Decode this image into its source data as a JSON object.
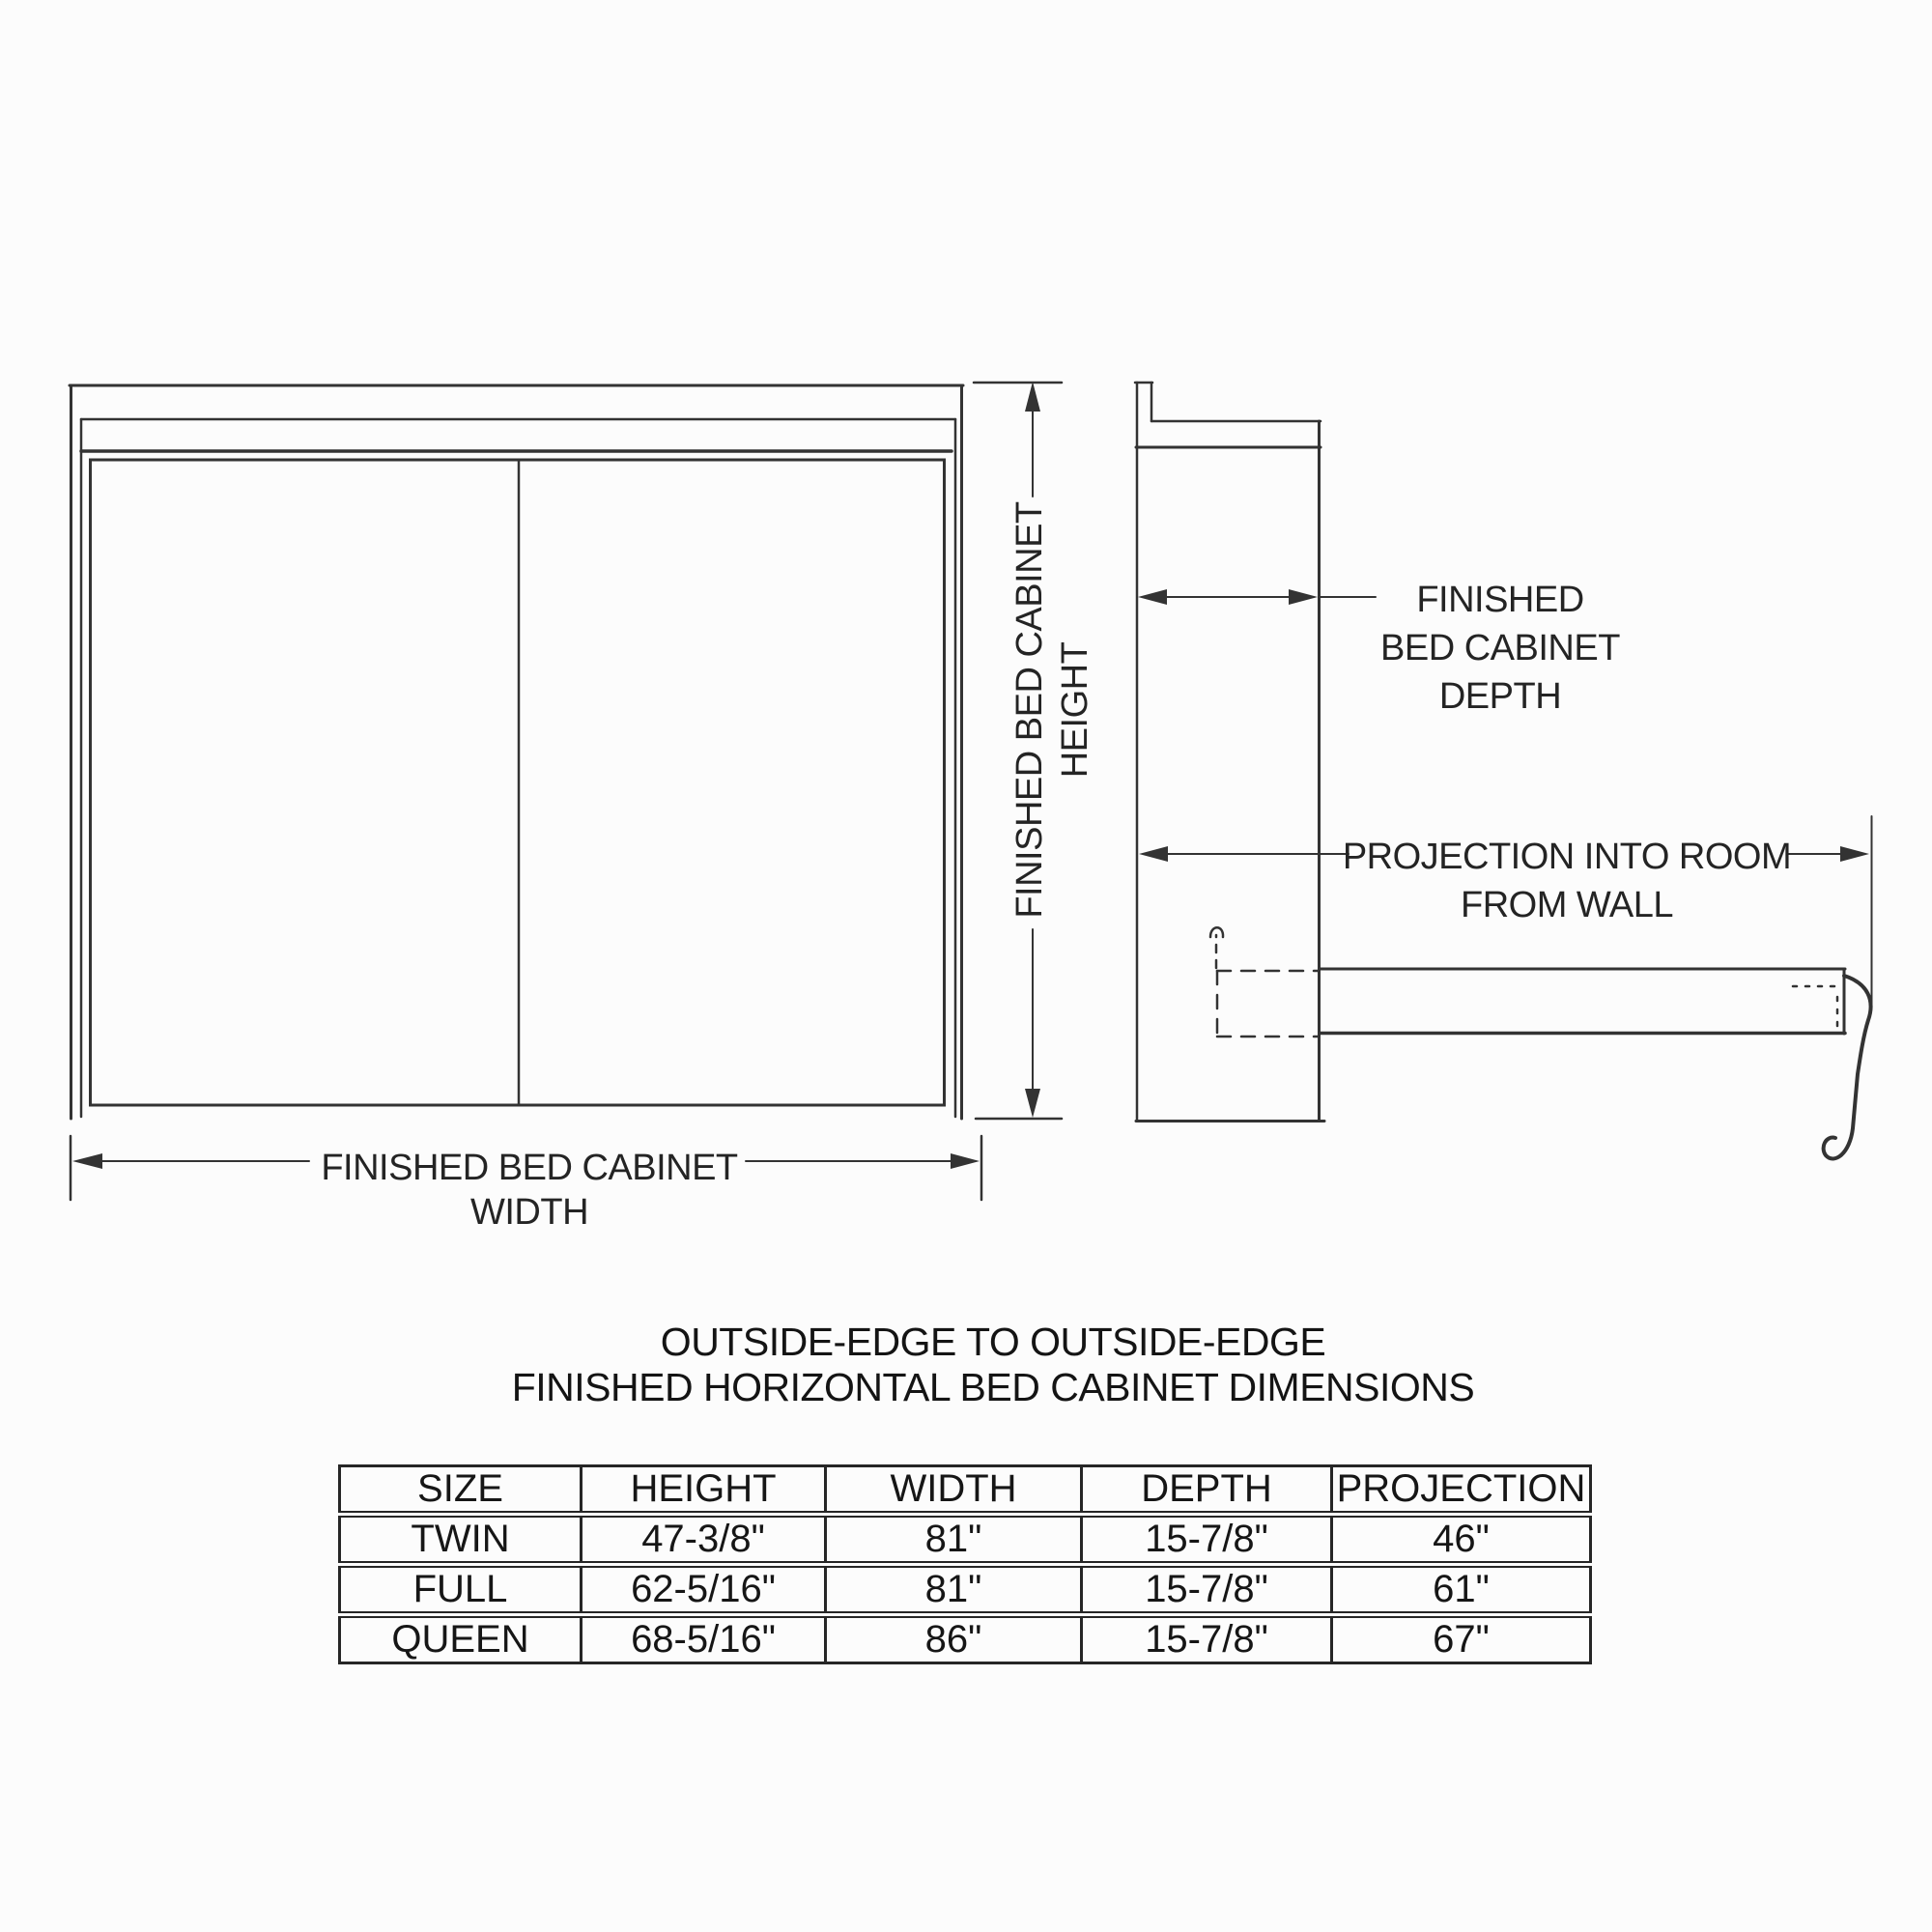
{
  "colors": {
    "ink": "#333333",
    "table_line": "#262626",
    "background": "#fcfcfc"
  },
  "labels": {
    "height": {
      "line1": "FINISHED BED CABINET",
      "line2": "HEIGHT"
    },
    "width": {
      "line1": "FINISHED BED CABINET",
      "line2": "WIDTH"
    },
    "depth": {
      "line1": "FINISHED",
      "line2": "BED CABINET",
      "line3": "DEPTH"
    },
    "projection": {
      "line1": "PROJECTION INTO ROOM",
      "line2": "FROM WALL"
    }
  },
  "title": {
    "line1": "OUTSIDE-EDGE TO OUTSIDE-EDGE",
    "line2": "FINISHED HORIZONTAL BED CABINET DIMENSIONS"
  },
  "table": {
    "headers": [
      "SIZE",
      "HEIGHT",
      "WIDTH",
      "DEPTH",
      "PROJECTION"
    ],
    "rows": [
      [
        "TWIN",
        "47-3/8\"",
        "81\"",
        "15-7/8\"",
        "46\""
      ],
      [
        "FULL",
        "62-5/16\"",
        "81\"",
        "15-7/8\"",
        "61\""
      ],
      [
        "QUEEN",
        "68-5/16\"",
        "86\"",
        "15-7/8\"",
        "67\""
      ]
    ]
  },
  "chart_data": {
    "type": "table",
    "title": "OUTSIDE-EDGE TO OUTSIDE-EDGE FINISHED HORIZONTAL BED CABINET DIMENSIONS",
    "columns": [
      "SIZE",
      "HEIGHT",
      "WIDTH",
      "DEPTH",
      "PROJECTION"
    ],
    "rows": [
      [
        "TWIN",
        "47-3/8\"",
        "81\"",
        "15-7/8\"",
        "46\""
      ],
      [
        "FULL",
        "62-5/16\"",
        "81\"",
        "15-7/8\"",
        "61\""
      ],
      [
        "QUEEN",
        "68-5/16\"",
        "86\"",
        "15-7/8\"",
        "67\""
      ]
    ]
  }
}
